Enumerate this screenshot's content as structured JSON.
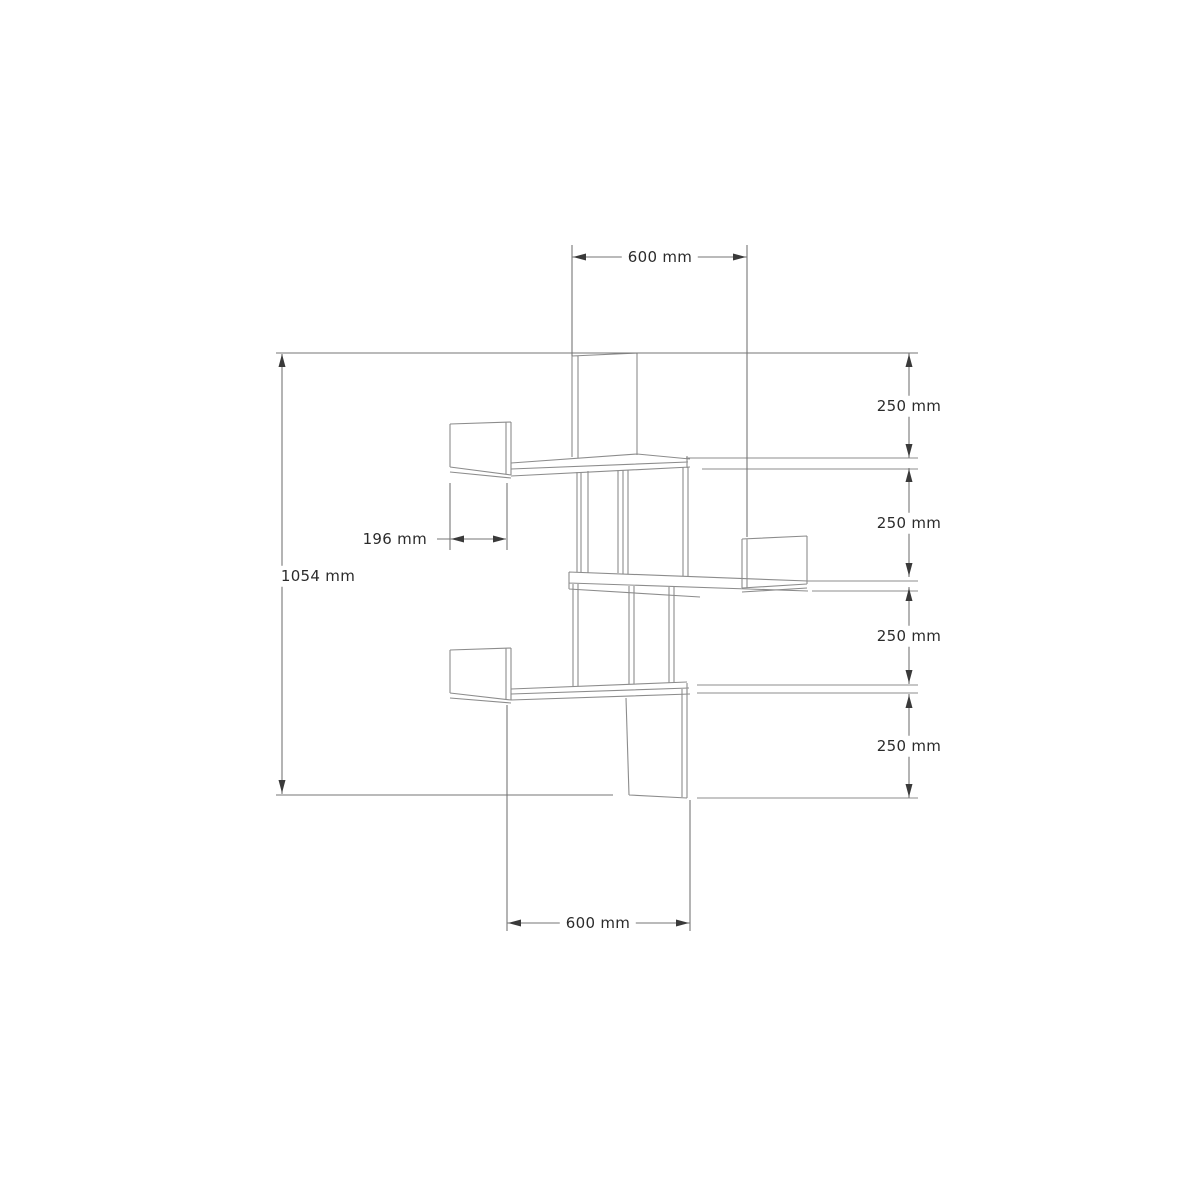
{
  "diagram": {
    "subject": "corner wall shelf dimension drawing",
    "unit": "mm",
    "dimensions": [
      {
        "id": "top-width",
        "label": "600 mm",
        "value": 600,
        "unit": "mm",
        "location": "top"
      },
      {
        "id": "tier-spacing-1",
        "label": "250 mm",
        "value": 250,
        "unit": "mm",
        "location": "right"
      },
      {
        "id": "tier-spacing-2",
        "label": "250 mm",
        "value": 250,
        "unit": "mm",
        "location": "right"
      },
      {
        "id": "tier-spacing-3",
        "label": "250 mm",
        "value": 250,
        "unit": "mm",
        "location": "right"
      },
      {
        "id": "tier-spacing-4",
        "label": "250 mm",
        "value": 250,
        "unit": "mm",
        "location": "right"
      },
      {
        "id": "total-height",
        "label": "1054 mm",
        "value": 1054,
        "unit": "mm",
        "location": "left"
      },
      {
        "id": "shelf-depth",
        "label": "196 mm",
        "value": 196,
        "unit": "mm",
        "location": "middle-left"
      },
      {
        "id": "bottom-width",
        "label": "600 mm",
        "value": 600,
        "unit": "mm",
        "location": "bottom"
      }
    ],
    "colors": {
      "background": "#ffffff",
      "structure_line": "#8c8c8c",
      "dimension_line": "#767676",
      "arrow": "#3a3a3a",
      "text": "#2b2b2b"
    }
  }
}
